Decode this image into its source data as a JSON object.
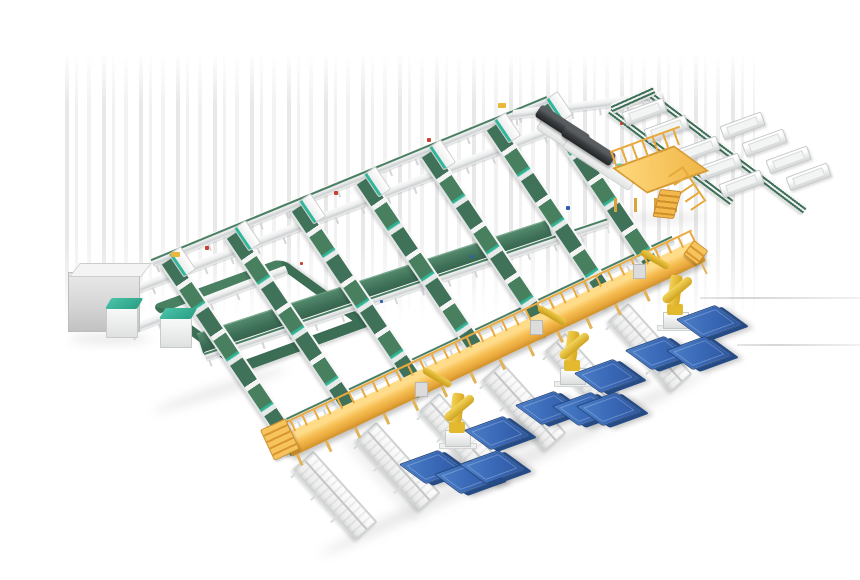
{
  "meta": {
    "description": "3D isometric render of an automated parcel sorting facility: seven elevated green belt sorter lanes feed a golden elevated operator walkway; three yellow robotic arms palletize onto blue floor pallets; top-right spur conveyor with white discharge troughs, two dark telescopic truck loaders, a yellow access platform with stairs, floor-level green recirculation loop and control cabinets.",
    "canvas": {
      "width": 860,
      "height": 580
    }
  },
  "palette": {
    "background": "#ffffff",
    "belt_green": "#3e7059",
    "belt_green_light": "#4a8062",
    "teal_accent": "#2db89a",
    "frame_white": "#f4f4f4",
    "frame_gray": "#cdd1d2",
    "walkway_gold": "#f6be52",
    "walkway_gold_dark": "#d0902c",
    "robot_yellow": "#e8c431",
    "pallet_blue": "#3a6ab8",
    "pallet_blue_dark": "#24477e",
    "loader_dark": "#393d40",
    "accent_red": "#c8402f",
    "accent_blue": "#2f5fb3",
    "accent_yellow": "#e9b83a"
  },
  "inventory": [
    {
      "component": "sorter-lane",
      "count": 7
    },
    {
      "component": "cross-conveyor-line",
      "count": 6
    },
    {
      "component": "wide-green-belt",
      "count": 1
    },
    {
      "component": "recirculation-loop",
      "count": 1
    },
    {
      "component": "elevated-walkway",
      "count": 1
    },
    {
      "component": "robot-arm",
      "count": 3
    },
    {
      "component": "blue-pallet",
      "count": 11
    },
    {
      "component": "output-roller-table",
      "count": 6
    },
    {
      "component": "discharge-trough",
      "count": 9
    },
    {
      "component": "spur-conveyor",
      "count": 3
    },
    {
      "component": "telescopic-loader",
      "count": 2
    },
    {
      "component": "access-platform",
      "count": 1
    },
    {
      "component": "control-cabinet",
      "count": 3
    }
  ],
  "scene": {
    "streaks": {
      "x": 65,
      "y": 52,
      "w": 690,
      "h": 268
    },
    "lanes": {
      "angle": 56,
      "items": [
        {
          "x": 168,
          "y": 251,
          "len": 231
        },
        {
          "x": 233,
          "y": 225,
          "len": 228
        },
        {
          "x": 298,
          "y": 198,
          "len": 225
        },
        {
          "x": 363,
          "y": 171,
          "len": 221
        },
        {
          "x": 428,
          "y": 144,
          "len": 218
        },
        {
          "x": 493,
          "y": 117,
          "len": 214
        },
        {
          "x": 545,
          "y": 96,
          "len": 211
        }
      ]
    },
    "xlines": [
      {
        "x": 152,
        "y": 258,
        "angle": -22.4,
        "len": 428,
        "green": true
      },
      {
        "x": 96,
        "y": 300,
        "angle": -21,
        "len": 505,
        "green": false
      },
      {
        "x": 128,
        "y": 326,
        "angle": -21,
        "len": 170,
        "green": false
      },
      {
        "x": 205,
        "y": 352,
        "angle": -18.5,
        "len": 425,
        "green": true
      },
      {
        "x": 268,
        "y": 426,
        "angle": -25.3,
        "len": 448,
        "green": true
      },
      {
        "x": 513,
        "y": 110,
        "angle": -7,
        "len": 152,
        "green": false
      }
    ],
    "greenband": {
      "x": 200,
      "y": 333,
      "angle": -18,
      "len": 368
    },
    "loop": {
      "x": 150,
      "y": 306
    },
    "walkway": {
      "x": 287,
      "y": 434,
      "angle": -25.3,
      "len": 458
    },
    "stairs": {
      "x": 260,
      "y": 430,
      "angle": -25
    },
    "ramp": {
      "x": 694,
      "y": 240,
      "angle": 37
    },
    "spurs": [
      {
        "x": 648,
        "y": 88,
        "angle": 37,
        "len": 196
      },
      {
        "x": 610,
        "y": 106,
        "angle": 37,
        "len": 152
      },
      {
        "x": 612,
        "y": 104,
        "angle": -24,
        "len": 46
      }
    ],
    "troughs": {
      "angle": -20,
      "items": [
        {
          "x": 722,
          "y": 126
        },
        {
          "x": 744,
          "y": 143
        },
        {
          "x": 768,
          "y": 160
        },
        {
          "x": 788,
          "y": 177
        },
        {
          "x": 677,
          "y": 150
        },
        {
          "x": 699,
          "y": 167
        },
        {
          "x": 721,
          "y": 184
        },
        {
          "x": 624,
          "y": 112
        },
        {
          "x": 646,
          "y": 129
        }
      ]
    },
    "otables": {
      "angle": 48,
      "len": 92,
      "items": [
        {
          "x": 303,
          "y": 446
        },
        {
          "x": 366,
          "y": 417
        },
        {
          "x": 429,
          "y": 388
        },
        {
          "x": 492,
          "y": 357
        },
        {
          "x": 555,
          "y": 328
        },
        {
          "x": 618,
          "y": 298
        }
      ]
    },
    "loaders": [
      {
        "x": 540,
        "y": 114,
        "angle": 33
      },
      {
        "x": 566,
        "y": 133,
        "angle": 33
      }
    ],
    "platform": {
      "x": 604,
      "y": 152
    },
    "cabinets": {
      "big": {
        "x": 68,
        "y": 272
      },
      "small": [
        {
          "x": 106,
          "y": 306
        },
        {
          "x": 160,
          "y": 316
        }
      ]
    },
    "robots": [
      {
        "x": 457,
        "y": 449
      },
      {
        "x": 572,
        "y": 387
      },
      {
        "x": 675,
        "y": 331
      }
    ],
    "pallets": [
      {
        "x": 688,
        "y": 308
      },
      {
        "x": 637,
        "y": 339
      },
      {
        "x": 678,
        "y": 339
      },
      {
        "x": 586,
        "y": 362
      },
      {
        "x": 527,
        "y": 394
      },
      {
        "x": 564,
        "y": 395
      },
      {
        "x": 588,
        "y": 395
      },
      {
        "x": 476,
        "y": 419
      },
      {
        "x": 411,
        "y": 453
      },
      {
        "x": 446,
        "y": 463
      },
      {
        "x": 471,
        "y": 453
      }
    ],
    "dots": [
      {
        "x": 171,
        "y": 252,
        "c": "#e9b83a",
        "w": 9,
        "h": 5
      },
      {
        "x": 498,
        "y": 103,
        "c": "#e9b83a",
        "w": 8,
        "h": 5
      },
      {
        "x": 205,
        "y": 246,
        "c": "#c8402f",
        "w": 4,
        "h": 4
      },
      {
        "x": 334,
        "y": 191,
        "c": "#c8402f",
        "w": 4,
        "h": 4
      },
      {
        "x": 427,
        "y": 138,
        "c": "#c8402f",
        "w": 4,
        "h": 4
      },
      {
        "x": 300,
        "y": 262,
        "c": "#c8402f",
        "w": 3,
        "h": 3
      },
      {
        "x": 620,
        "y": 122,
        "c": "#c8402f",
        "w": 3,
        "h": 3
      },
      {
        "x": 566,
        "y": 206,
        "c": "#2f5fb3",
        "w": 4,
        "h": 4
      },
      {
        "x": 380,
        "y": 300,
        "c": "#2f5fb3",
        "w": 3,
        "h": 3
      },
      {
        "x": 470,
        "y": 255,
        "c": "#2f5fb3",
        "w": 3,
        "h": 3
      }
    ],
    "shadowlines": [
      {
        "x": 700,
        "y": 297,
        "len": 160
      },
      {
        "x": 737,
        "y": 344,
        "len": 123
      }
    ],
    "gshadows": [
      {
        "x": 300,
        "y": 455,
        "w": 430,
        "h": 16,
        "rot": -25.3
      },
      {
        "x": 70,
        "y": 334,
        "w": 80,
        "h": 10,
        "rot": 0
      },
      {
        "x": 150,
        "y": 385,
        "w": 140,
        "h": 10,
        "rot": -18
      },
      {
        "x": 618,
        "y": 214,
        "w": 90,
        "h": 8,
        "rot": 0
      },
      {
        "x": 320,
        "y": 472,
        "w": 120,
        "h": 8,
        "rot": 48
      }
    ]
  }
}
